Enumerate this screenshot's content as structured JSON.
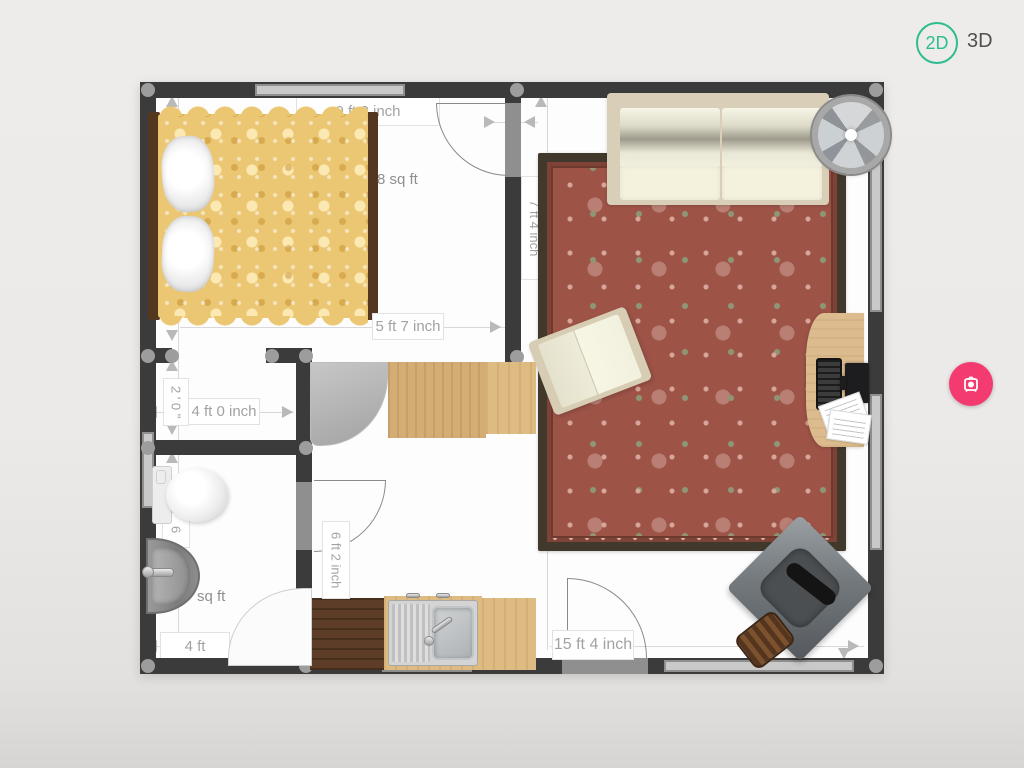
{
  "toolbar": {
    "view_2d": "2D",
    "view_3d": "3D",
    "accent_teal": "#2fbc8f",
    "snapshot_pink": "#f43b70",
    "snapshot_icon": "camera-icon"
  },
  "dimensions": {
    "bedroom_top_width": "9 ft 2 inch",
    "bedroom_area": "8 sq ft",
    "bedroom_bottom_width": "5 ft 7 inch",
    "closet_depth": "2 ' 0 \"",
    "closet_width": "4 ft 0 inch",
    "living_room_height": "7 ft 4 inch",
    "bathroom_side": "6",
    "bathroom_area": "sq ft",
    "bathroom_width": "4 ft",
    "kitchen_door_height": "6 ft 2 inch",
    "living_room_width": "15 ft 4 inch"
  }
}
